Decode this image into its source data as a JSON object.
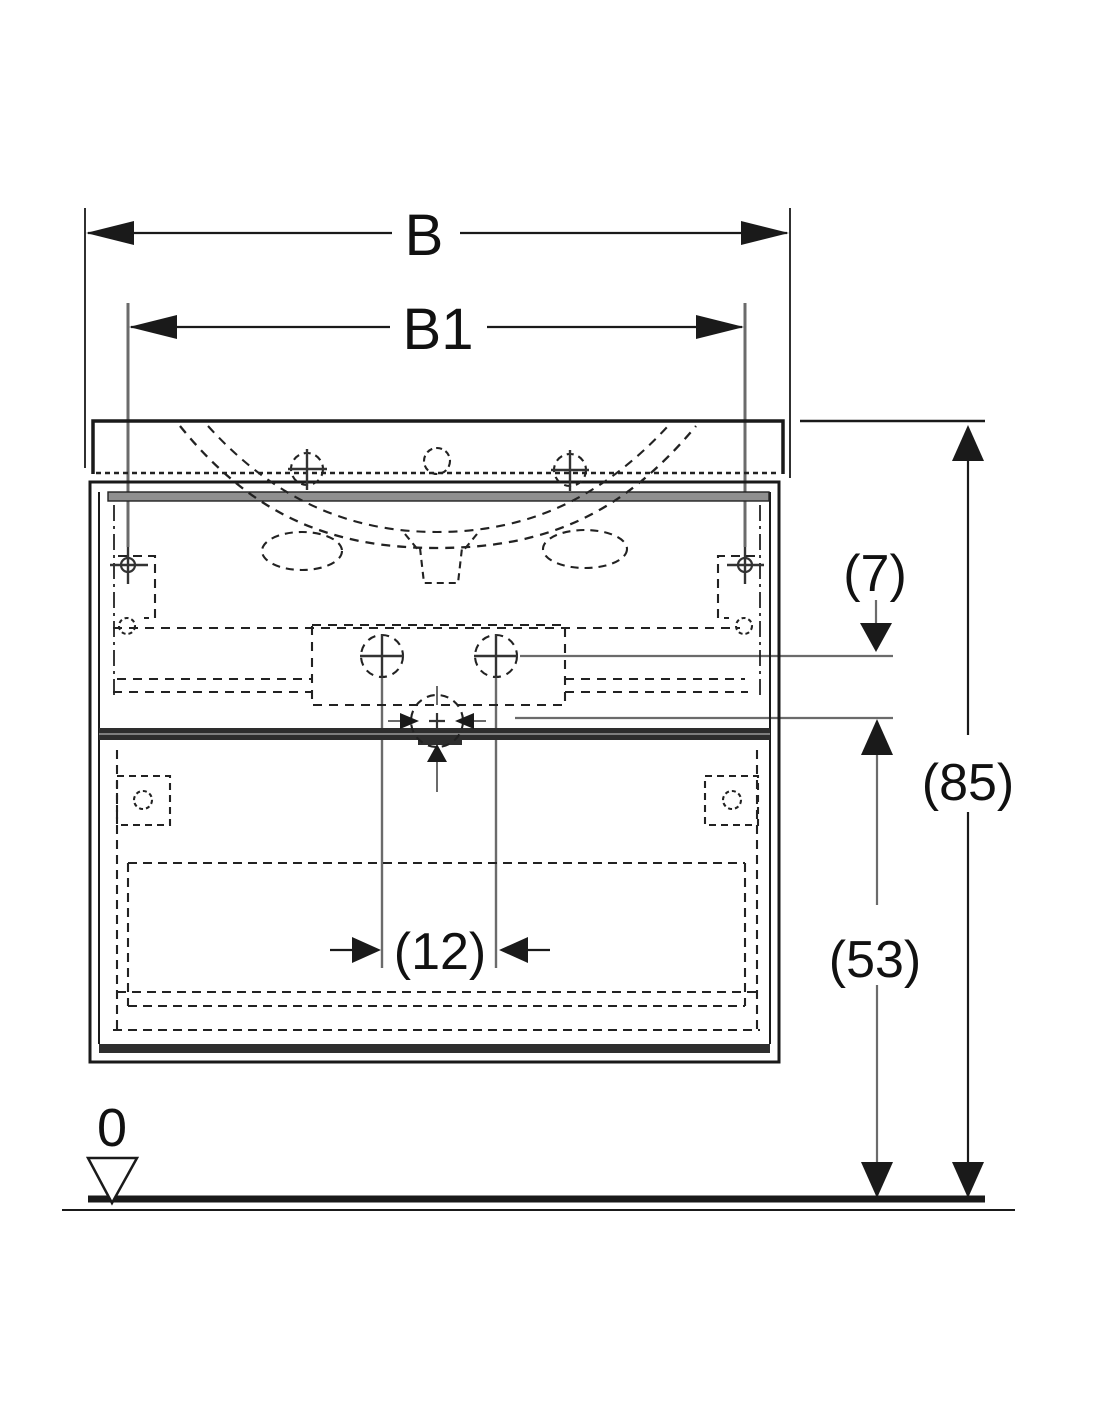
{
  "drawing": {
    "type": "technical-dimension-drawing",
    "subject": "washbasin-cabinet-front-view",
    "dimensions": {
      "overall_width": "B",
      "fixing_width": "B1",
      "top_offset": "(7)",
      "overall_height": "(85)",
      "drain_spacing": "(12)",
      "lower_height": "(53)",
      "floor_level": "0"
    }
  },
  "colors": {
    "ink": "#1a1a1a",
    "gray": "#6b6b6b",
    "band": "#8f8f8f",
    "divider": "#2e2e2e",
    "background": "#ffffff"
  }
}
